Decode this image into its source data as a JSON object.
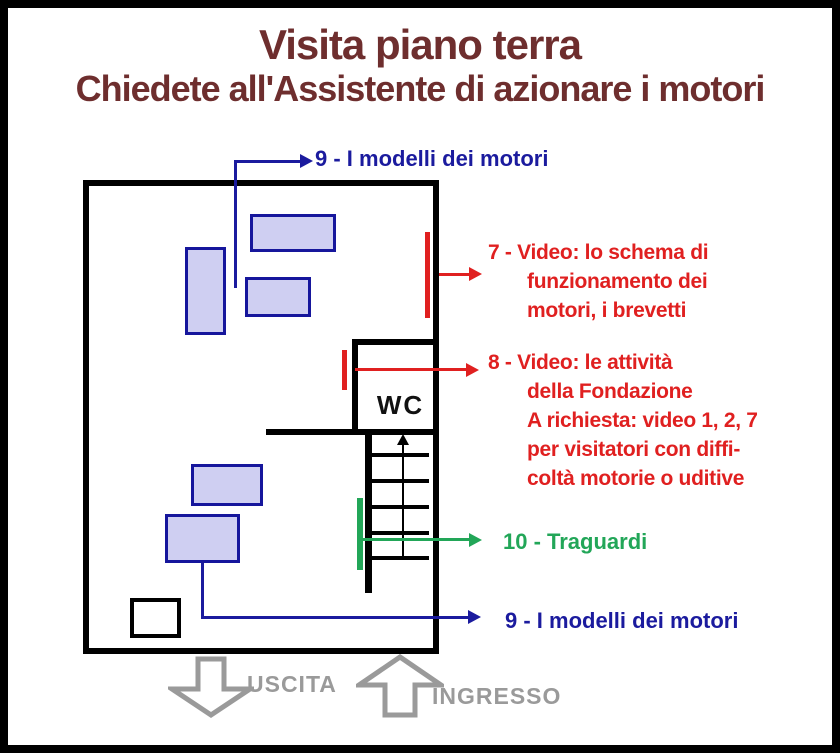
{
  "page": {
    "title_line1": "Visita piano terra",
    "title_line2": "Chiedete all'Assistente di azionare i motori"
  },
  "colors": {
    "title": "#6e2e2e",
    "red": "#e02020",
    "blue": "#1b1b9e",
    "green": "#22a658",
    "gray": "#9a9a9a",
    "roomFill": "#cfcff2",
    "roomBorder": "#16169c"
  },
  "plan": {
    "wc_label": "WC"
  },
  "annotations": {
    "models_top": {
      "text": "9 - I modelli dei motori"
    },
    "video7": {
      "lines": [
        "7 - Video: lo schema di",
        "funzionamento dei",
        "motori, i brevetti"
      ]
    },
    "video8": {
      "lines": [
        "8 - Video: le attività",
        "della Fondazione",
        "A richiesta: video 1, 2, 7",
        "per visitatori con diffi-",
        "coltà motorie o uditive"
      ]
    },
    "traguardi": {
      "text": "10 - Traguardi"
    },
    "models_bottom": {
      "text": "9 - I modelli dei motori"
    }
  },
  "footer": {
    "exit_label": "USCITA",
    "entrance_label": "INGRESSO"
  }
}
